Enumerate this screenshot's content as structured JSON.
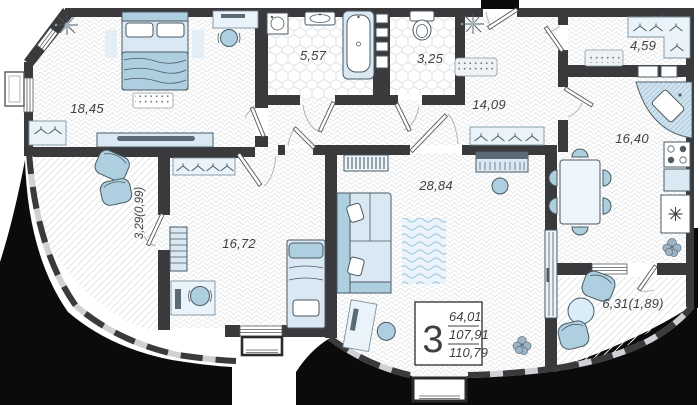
{
  "plan": {
    "title": "3-room apartment floor plan",
    "rooms": [
      {
        "id": "bedroom-1",
        "area": "18,45"
      },
      {
        "id": "bathroom",
        "area": "5,57"
      },
      {
        "id": "wc",
        "area": "3,25"
      },
      {
        "id": "hallway",
        "area": "14,09"
      },
      {
        "id": "dressing-room",
        "area": "4,59"
      },
      {
        "id": "kitchen",
        "area": "16,40"
      },
      {
        "id": "living-room",
        "area": "28,84"
      },
      {
        "id": "bedroom-2",
        "area": "16,72"
      },
      {
        "id": "balcony-left",
        "area": "3,29(0,99)"
      },
      {
        "id": "balcony-right",
        "area": "6,31(1,89)"
      }
    ],
    "info": {
      "rooms_count": "3",
      "area_living": "64,01",
      "area_middle": "107,91",
      "area_total": "110,79"
    },
    "icons": [
      "bed-icon",
      "wardrobe-hanger-icon",
      "desk-icon",
      "office-chair-icon",
      "tv-console-icon",
      "washing-machine-icon",
      "sink-icon",
      "bathtub-icon",
      "toilet-icon",
      "ceiling-light-icon",
      "doormat-icon",
      "corner-sink-icon",
      "stove-icon",
      "fridge-snowflake-icon",
      "dining-table-icon",
      "sofa-icon",
      "piano-icon",
      "radiator-icon",
      "rug-icon",
      "plant-icon",
      "lounge-chair-icon",
      "entrance-door-icon",
      "door-leaf-icon"
    ],
    "colors": {
      "wall": "#3a3a3c",
      "building_mass": "#0b0b0c",
      "furniture_fill": "#d9e8f2",
      "furniture_accent": "#aecfe0",
      "text": "#3e4043",
      "background": "#ffffff"
    }
  }
}
